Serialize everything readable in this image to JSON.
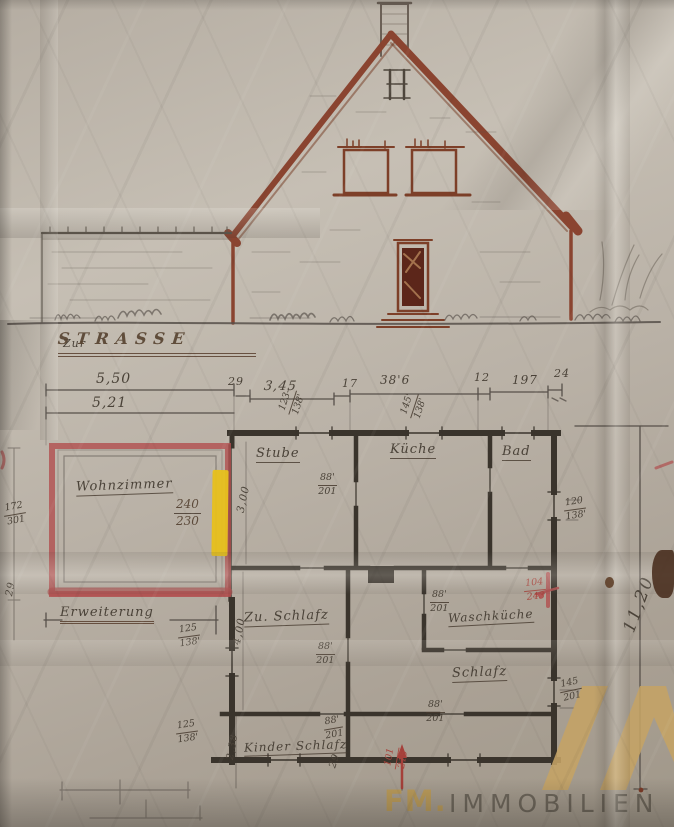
{
  "elevation": {
    "street_prefix": "Zur",
    "street": "STRASSE"
  },
  "dims_top": {
    "d550": "5,50",
    "d521": "5,21",
    "d29": "29",
    "d345": "3,45",
    "rot1_top": "123-",
    "rot1_bot": "138'",
    "d17": "17",
    "d386": "38'6",
    "rot2_top": "145'",
    "rot2_bot": "138'",
    "d12": "12",
    "d197": "197",
    "d24": "24"
  },
  "plan": {
    "rooms": {
      "stube": "Stube",
      "kueche": "Küche",
      "bad": "Bad",
      "wohnzimmer": "Wohnzimmer",
      "zu_schlafz": "Zu. Schlafz",
      "waschkueche": "Waschküche",
      "schlafz": "Schlafz",
      "kinder": "Kinder Schlafz"
    },
    "erweiterung": "Erweiterung",
    "fracs": {
      "stube_door": {
        "top": "88'",
        "bot": "201"
      },
      "wohnzimmer": {
        "top": "240",
        "bot": "230"
      },
      "left_outer": {
        "top": "172",
        "bot": "301"
      },
      "right_upper": {
        "top": "120",
        "bot": "138'"
      },
      "erw": {
        "top": "125",
        "bot": "138'"
      },
      "zu_door": {
        "top": "88'",
        "bot": "201"
      },
      "waschk_door": {
        "top": "88'",
        "bot": "201"
      },
      "waschk_red": {
        "top": "104",
        "bot": "243"
      },
      "right_lower": {
        "top": "145",
        "bot": "201"
      },
      "schlafz_door": {
        "top": "88'",
        "bot": "201"
      },
      "bottom_left": {
        "top": "125",
        "bot": "138'"
      },
      "bottom_mid": {
        "top": "88'",
        "bot": "201"
      },
      "red_bottom": {
        "top": "101",
        "bot": "215"
      }
    },
    "verticals": {
      "v1120": "11,20",
      "v400": "4,00",
      "v300": "3,00",
      "v238": "2,38",
      "v29_left": "29",
      "v29_bottom": "29"
    }
  },
  "watermark": {
    "fm": "FM.",
    "immobilien": "IMMOBILIEN"
  }
}
